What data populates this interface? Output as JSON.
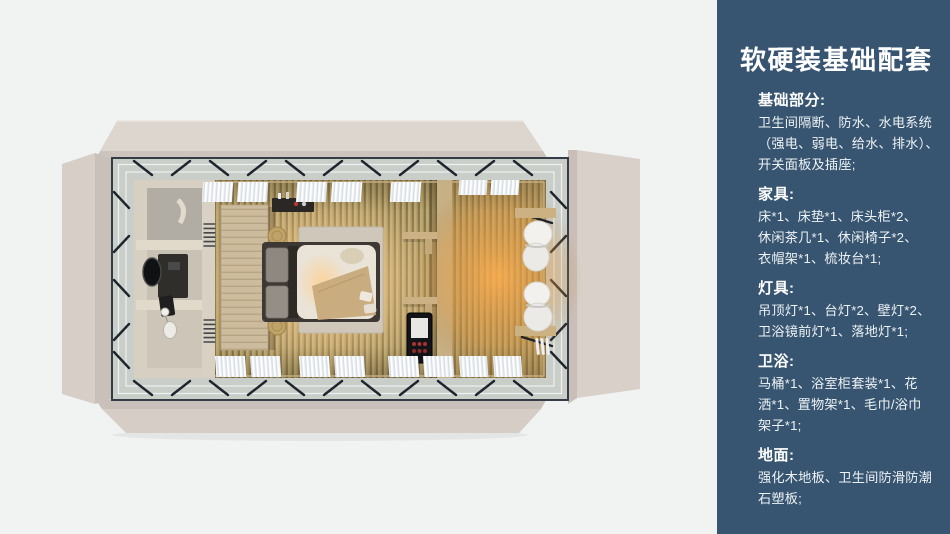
{
  "sidebar": {
    "bg_color": "#375570",
    "text_color": "#ffffff",
    "title": "软硬装基础配套",
    "sections": [
      {
        "heading": "基础部分:",
        "lines": [
          "卫生间隔断、防水、水电系统",
          "（强电、弱电、给水、排水）、",
          "开关面板及插座;"
        ]
      },
      {
        "heading": "家具:",
        "lines": [
          "床*1、床垫*1、床头柜*2、",
          "休闲茶几*1、休闲椅子*2、",
          "衣帽架*1、梳妆台*1;"
        ]
      },
      {
        "heading": "灯具:",
        "lines": [
          "吊顶灯*1、台灯*2、壁灯*2、",
          "卫浴镜前灯*1、落地灯*1;"
        ]
      },
      {
        "heading": "卫浴:",
        "lines": [
          "马桶*1、浴室柜套装*1、花",
          "洒*1、置物架*1、毛巾/浴巾",
          "架子*1;"
        ]
      },
      {
        "heading": "地面:",
        "lines": [
          "强化木地板、卫生间防滑防潮",
          "石塑板;"
        ]
      }
    ]
  },
  "floorplan": {
    "view": "top-down-3d-render",
    "colors": {
      "page_bg": "#f1f2f2",
      "platform_beige": "#d8d0c9",
      "glass_band": "#c9cec9",
      "steel_frame": "#343c48",
      "wood_floor": "#ab9662",
      "warm_glow": "#ffa540",
      "bathroom_wall": "#d7cfc1",
      "bed_duvet": "#e9e3d8"
    },
    "areas": [
      {
        "name": "bathroom"
      },
      {
        "name": "bedroom"
      },
      {
        "name": "lounge"
      }
    ]
  }
}
